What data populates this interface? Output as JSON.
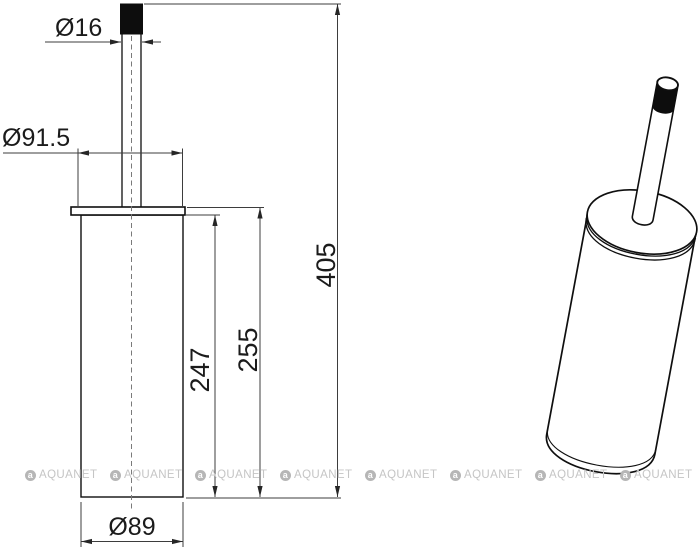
{
  "drawing": {
    "front_view": {
      "dimensions": {
        "handle_diameter": "Ø16",
        "lid_diameter": "Ø91.5",
        "body_height": "247",
        "body_with_lid_height": "255",
        "total_height": "405",
        "body_diameter": "Ø89"
      }
    },
    "views": {
      "front": "front-orthographic-view",
      "iso": "isometric-view"
    }
  },
  "watermark": {
    "text": "AQUANET",
    "icon": "aquanet-logo-circle",
    "color": "#c5c5c5"
  },
  "colors": {
    "background": "#ffffff",
    "object_line": "#0f0f0f",
    "dimension_line": "#3d3d3d",
    "handle_tip_fill": "#0d0d0d",
    "centerline": "#7a7a7a"
  }
}
